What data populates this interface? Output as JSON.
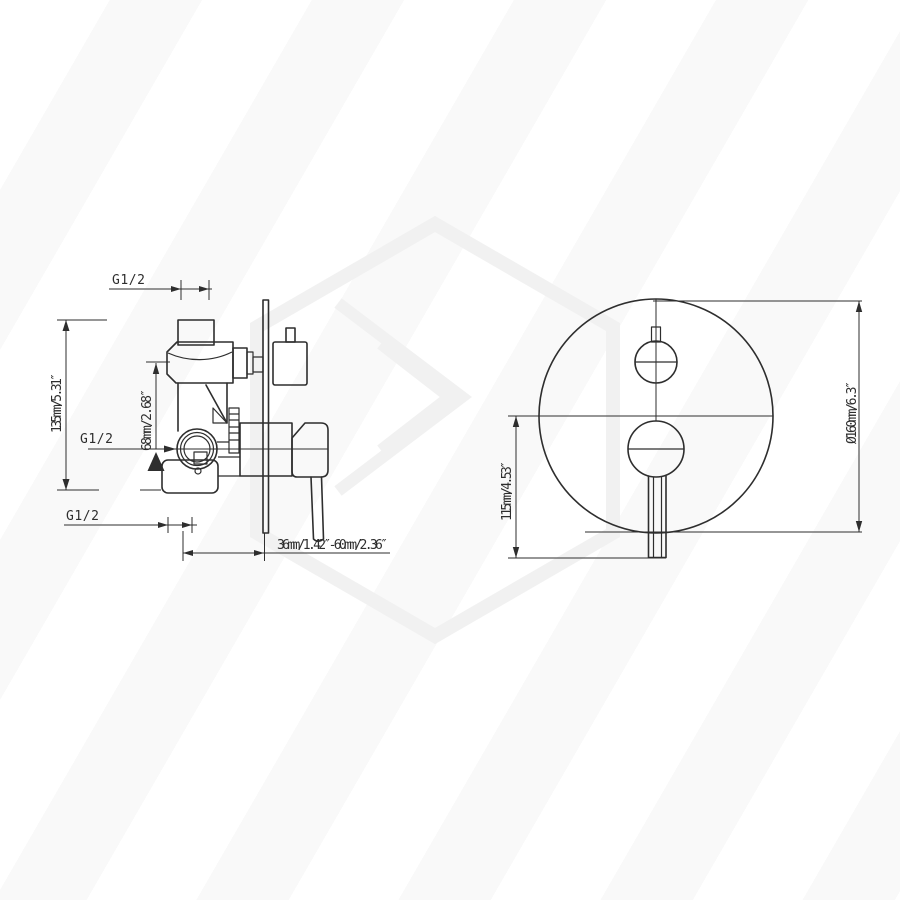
{
  "colors": {
    "line": "#2e2e2e",
    "watermark": "#f1f1f1",
    "background": "#ffffff"
  },
  "side_view": {
    "labels": {
      "top_port": "G1/2",
      "side_port": "G1/2",
      "bottom_port": "G1/2",
      "body_height": "135mm/5.31″",
      "port_offset": "68mm/2.68″",
      "install_depth": "36mm/1.42″-60mm/2.36″"
    }
  },
  "front_view": {
    "labels": {
      "handle_drop": "115mm/4.53″",
      "plate_diameter": "Ø160mm/6.3″"
    }
  }
}
